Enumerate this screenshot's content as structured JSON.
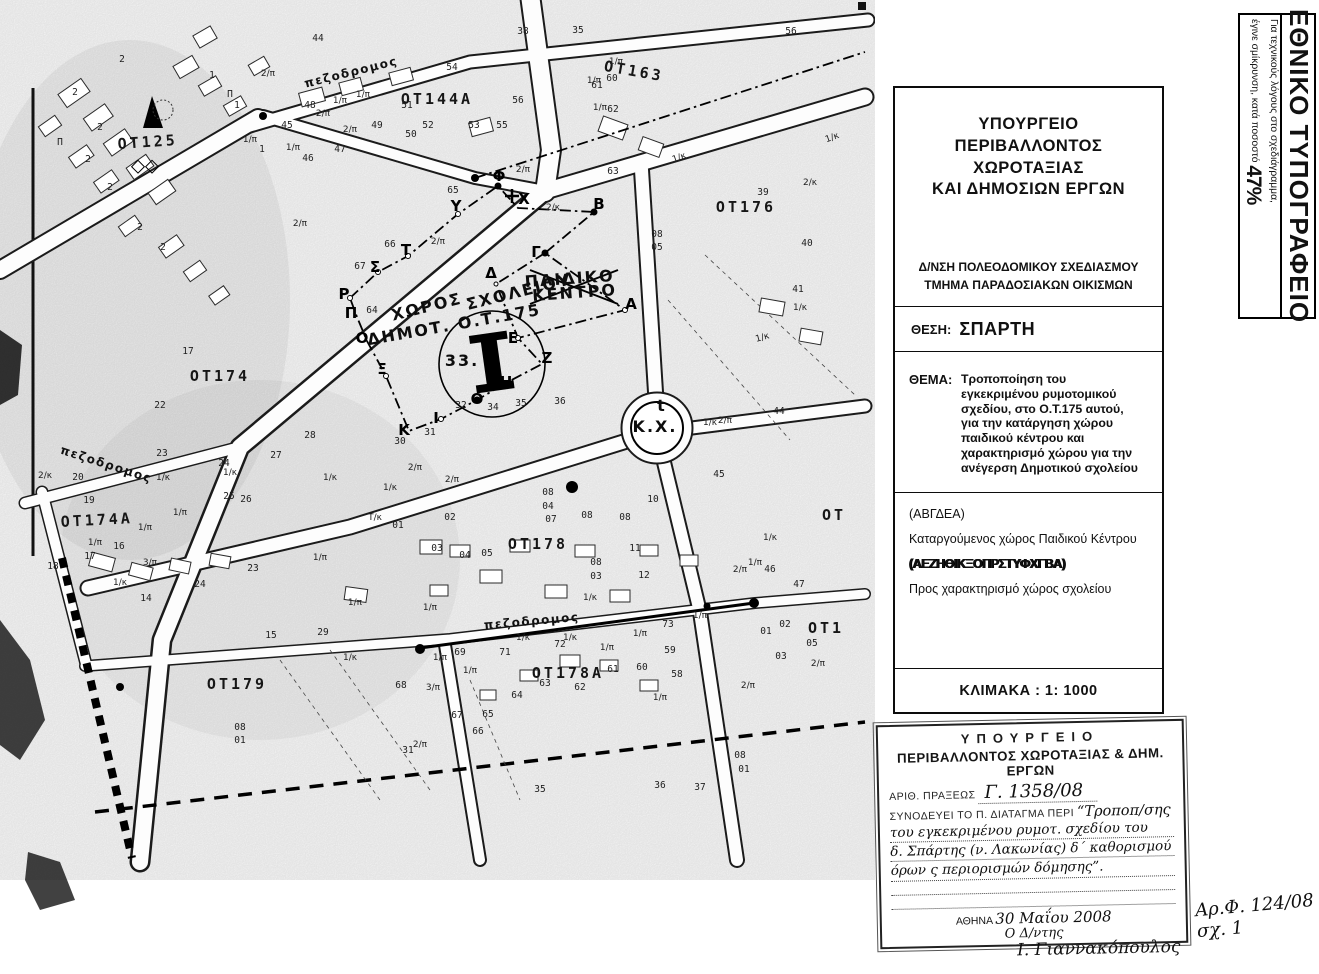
{
  "banner": {
    "title": "ΕΘΝΙΚΟ ΤΥΠΟΓΡΑΦΕΙΟ",
    "note1": "Για τεχνικούς λόγους στο σχεδιάγραμμα,",
    "note2": "έγινε σμίκρυνση, κατά ποσοστό",
    "percent": "47%"
  },
  "title_block": {
    "ministry": [
      "ΥΠΟΥΡΓΕΙΟ",
      "ΠΕΡΙΒΑΛΛΟΝΤΟΣ",
      "ΧΩΡΟΤΑΞΙΑΣ",
      "ΚΑΙ ΔΗΜΟΣΙΩΝ ΕΡΓΩΝ"
    ],
    "directorate": "Δ/ΝΣΗ ΠΟΛΕΟΔΟΜΙΚΟΥ ΣΧΕΔΙΑΣΜΟΥ",
    "department": "ΤΜΗΜΑ ΠΑΡΑΔΟΣΙΑΚΩΝ ΟΙΚΙΣΜΩΝ",
    "location_label": "ΘΕΣΗ:",
    "location": "ΣΠΑΡΤΗ",
    "subject_label": "ΘΕΜΑ:",
    "subject_lines": [
      "Τροποποίηση του",
      "εγκεκριμένου ρυμοτομικού",
      "σχεδίου, στο Ο.Τ.175 αυτού,",
      "για την κατάργηση χώρου",
      "παιδικού κέντρου και",
      "χαρακτηρισμό χώρου για την",
      "ανέγερση Δημοτικού σχολείου"
    ],
    "legend": {
      "code1": "(ΑΒΓΔΕΑ)",
      "desc1": "Καταργούμενος χώρος Παιδικού Κέντρου",
      "code2": "(ΑΕΖΗΘΙΚΞΟΠΡΣΤΥΦΧΓΒΑ)",
      "desc2": "Προς χαρακτηρισμό χώρος σχολείου"
    },
    "scale": "ΚΛΙΜΑΚΑ : 1: 1000"
  },
  "stamp": {
    "header1": "ΥΠΟΥΡΓΕΙΟ",
    "header2": "ΠΕΡΙΒΑΛΛΟΝΤΟΣ ΧΩΡΟΤΑΞΙΑΣ & ΔΗΜ. ΕΡΓΩΝ",
    "row1_label": "ΑΡΙΘ. ΠΡΑΞΕΩΣ",
    "row1_value": "Γ. 1358/08",
    "row2_label": "ΣΥΝΟΔΕΥΕΙ ΤΟ Π. ΔΙΑΤΑΓΜΑ ΠΕΡΙ",
    "row2_value": "“Τροποπ/σης",
    "hw_line1": "του εγκεκριμένου ρυμοτ. σχεδίου του",
    "hw_line2": "δ. Σπάρτης (ν. Λακωνίας) δ΄ καθορισμού",
    "hw_line3": "όρων ς περιορισμών δόμησης”.",
    "city_label": "ΑΘΗΝΑ",
    "date": "30 Μαΐου 2008",
    "signer_title": "Ο Δ/ντης",
    "signature": "Ι. Γιαννακόπουλος"
  },
  "file_note": {
    "line1": "Αρ.Φ. 124/08",
    "line2": "σχ. 1"
  },
  "map": {
    "blocks": [
      {
        "t": "ΟΤ125",
        "x": 148,
        "y": 147,
        "r": -4
      },
      {
        "t": "ΟΤ144Α",
        "x": 437,
        "y": 104,
        "r": 0
      },
      {
        "t": "ΟΤ163",
        "x": 633,
        "y": 76,
        "r": 10
      },
      {
        "t": "ΟΤ176",
        "x": 746,
        "y": 212,
        "r": 0
      },
      {
        "t": "ΟΤ174",
        "x": 220,
        "y": 381,
        "r": 0
      },
      {
        "t": "ΟΤ174Α",
        "x": 97,
        "y": 525,
        "r": -3
      },
      {
        "t": "ΟΤ178",
        "x": 538,
        "y": 549,
        "r": 0
      },
      {
        "t": "ΟΤ178Α",
        "x": 568,
        "y": 678,
        "r": 0
      },
      {
        "t": "ΟΤ179",
        "x": 237,
        "y": 689,
        "r": 0
      },
      {
        "t": "ΟΤ",
        "x": 834,
        "y": 520,
        "r": 0
      },
      {
        "t": "ΟΤ1",
        "x": 826,
        "y": 633,
        "r": 0
      }
    ],
    "street_labels": [
      {
        "t": "πεζοδρομος",
        "x": 352,
        "y": 76,
        "r": -14
      },
      {
        "t": "πεζοδρομος",
        "x": 105,
        "y": 468,
        "r": 18
      },
      {
        "t": "πεζοδρομος",
        "x": 532,
        "y": 625,
        "r": -5
      }
    ],
    "site_labels": [
      {
        "t": "ΧΩΡΟΣ",
        "x": 428,
        "y": 312,
        "r": -14
      },
      {
        "t": "ΣΧΟΛΕΙΟΥ",
        "x": 520,
        "y": 297,
        "r": -14
      },
      {
        "t": "ΔΗΜΟΤ. Ο.Τ.175",
        "x": 455,
        "y": 330,
        "r": -10
      },
      {
        "t": "ΠΑΙΔΙΚΟ",
        "x": 570,
        "y": 284,
        "r": -4,
        "small": true
      },
      {
        "t": "ΚΕΝΤΡΟ",
        "x": 575,
        "y": 298,
        "r": -4,
        "small": true
      },
      {
        "t": "Κ.Χ.",
        "x": 655,
        "y": 432,
        "r": 0,
        "small": true
      },
      {
        "t": "t",
        "x": 662,
        "y": 411,
        "r": 0,
        "small": true
      },
      {
        "t": "33.",
        "x": 462,
        "y": 366,
        "r": 0,
        "small": true
      }
    ],
    "vertex_letters": [
      {
        "t": "Ρ",
        "x": 344,
        "y": 299
      },
      {
        "t": "Σ",
        "x": 375,
        "y": 272
      },
      {
        "t": "Τ",
        "x": 406,
        "y": 255
      },
      {
        "t": "Υ",
        "x": 456,
        "y": 211
      },
      {
        "t": "Φ",
        "x": 499,
        "y": 181
      },
      {
        "t": "Χ",
        "x": 524,
        "y": 204
      },
      {
        "t": "Β",
        "x": 599,
        "y": 209
      },
      {
        "t": "Γ",
        "x": 536,
        "y": 257
      },
      {
        "t": "Α",
        "x": 631,
        "y": 309
      },
      {
        "t": "Δ",
        "x": 491,
        "y": 278
      },
      {
        "t": "Ε",
        "x": 513,
        "y": 343
      },
      {
        "t": "Ζ",
        "x": 547,
        "y": 363
      },
      {
        "t": "Η",
        "x": 506,
        "y": 387
      },
      {
        "t": "Θ",
        "x": 477,
        "y": 404
      },
      {
        "t": "Ι",
        "x": 436,
        "y": 423
      },
      {
        "t": "Κ",
        "x": 404,
        "y": 435
      },
      {
        "t": "Ξ",
        "x": 382,
        "y": 374
      },
      {
        "t": "Ο",
        "x": 362,
        "y": 343
      },
      {
        "t": "Π",
        "x": 351,
        "y": 318
      }
    ],
    "numbers": [
      {
        "t": "44",
        "x": 318,
        "y": 41
      },
      {
        "t": "54",
        "x": 452,
        "y": 70
      },
      {
        "t": "38",
        "x": 523,
        "y": 34
      },
      {
        "t": "35",
        "x": 578,
        "y": 33
      },
      {
        "t": "56",
        "x": 791,
        "y": 34
      },
      {
        "t": "45",
        "x": 287,
        "y": 128
      },
      {
        "t": "46",
        "x": 308,
        "y": 161
      },
      {
        "t": "47",
        "x": 340,
        "y": 152
      },
      {
        "t": "48",
        "x": 310,
        "y": 108
      },
      {
        "t": "49",
        "x": 377,
        "y": 128
      },
      {
        "t": "50",
        "x": 411,
        "y": 137
      },
      {
        "t": "51",
        "x": 407,
        "y": 108
      },
      {
        "t": "52",
        "x": 428,
        "y": 128
      },
      {
        "t": "53",
        "x": 474,
        "y": 128
      },
      {
        "t": "55",
        "x": 502,
        "y": 128
      },
      {
        "t": "56",
        "x": 518,
        "y": 103
      },
      {
        "t": "60",
        "x": 612,
        "y": 81
      },
      {
        "t": "61",
        "x": 597,
        "y": 88
      },
      {
        "t": "62",
        "x": 613,
        "y": 112
      },
      {
        "t": "63",
        "x": 613,
        "y": 174
      },
      {
        "t": "39",
        "x": 763,
        "y": 195
      },
      {
        "t": "40",
        "x": 807,
        "y": 246
      },
      {
        "t": "41",
        "x": 798,
        "y": 292
      },
      {
        "t": "65",
        "x": 453,
        "y": 193
      },
      {
        "t": "66",
        "x": 390,
        "y": 247
      },
      {
        "t": "67",
        "x": 360,
        "y": 269
      },
      {
        "t": "64",
        "x": 372,
        "y": 313
      },
      {
        "t": "08",
        "x": 657,
        "y": 237
      },
      {
        "t": "05",
        "x": 657,
        "y": 250
      },
      {
        "t": "17",
        "x": 188,
        "y": 354
      },
      {
        "t": "22",
        "x": 160,
        "y": 408
      },
      {
        "t": "23",
        "x": 162,
        "y": 456
      },
      {
        "t": "24",
        "x": 224,
        "y": 466
      },
      {
        "t": "25",
        "x": 229,
        "y": 499
      },
      {
        "t": "26",
        "x": 246,
        "y": 502
      },
      {
        "t": "27",
        "x": 276,
        "y": 458
      },
      {
        "t": "28",
        "x": 310,
        "y": 438
      },
      {
        "t": "30",
        "x": 400,
        "y": 444
      },
      {
        "t": "31",
        "x": 430,
        "y": 435
      },
      {
        "t": "32",
        "x": 461,
        "y": 408
      },
      {
        "t": "34",
        "x": 493,
        "y": 410
      },
      {
        "t": "35",
        "x": 521,
        "y": 406
      },
      {
        "t": "36",
        "x": 560,
        "y": 404
      },
      {
        "t": "44",
        "x": 779,
        "y": 414
      },
      {
        "t": "45",
        "x": 719,
        "y": 477
      },
      {
        "t": "10",
        "x": 653,
        "y": 502
      },
      {
        "t": "11",
        "x": 635,
        "y": 551
      },
      {
        "t": "12",
        "x": 644,
        "y": 578
      },
      {
        "t": "46",
        "x": 770,
        "y": 572
      },
      {
        "t": "47",
        "x": 799,
        "y": 587
      },
      {
        "t": "20",
        "x": 78,
        "y": 480
      },
      {
        "t": "19",
        "x": 89,
        "y": 503
      },
      {
        "t": "18",
        "x": 53,
        "y": 569
      },
      {
        "t": "17",
        "x": 90,
        "y": 559
      },
      {
        "t": "16",
        "x": 119,
        "y": 549
      },
      {
        "t": "14",
        "x": 146,
        "y": 601
      },
      {
        "t": "23",
        "x": 253,
        "y": 571
      },
      {
        "t": "24",
        "x": 200,
        "y": 587
      },
      {
        "t": "15",
        "x": 271,
        "y": 638
      },
      {
        "t": "29",
        "x": 323,
        "y": 635
      },
      {
        "t": "01",
        "x": 398,
        "y": 528
      },
      {
        "t": "02",
        "x": 450,
        "y": 520
      },
      {
        "t": "03",
        "x": 437,
        "y": 551
      },
      {
        "t": "04",
        "x": 465,
        "y": 558
      },
      {
        "t": "05",
        "x": 487,
        "y": 556
      },
      {
        "t": "07",
        "x": 551,
        "y": 522
      },
      {
        "t": "08",
        "x": 587,
        "y": 518
      },
      {
        "t": "08",
        "x": 625,
        "y": 520
      },
      {
        "t": "08",
        "x": 548,
        "y": 495
      },
      {
        "t": "04",
        "x": 548,
        "y": 509
      },
      {
        "t": "08",
        "x": 596,
        "y": 565
      },
      {
        "t": "03",
        "x": 596,
        "y": 579
      },
      {
        "t": "69",
        "x": 460,
        "y": 655
      },
      {
        "t": "71",
        "x": 505,
        "y": 655
      },
      {
        "t": "72",
        "x": 560,
        "y": 647
      },
      {
        "t": "73",
        "x": 668,
        "y": 627
      },
      {
        "t": "59",
        "x": 670,
        "y": 653
      },
      {
        "t": "60",
        "x": 642,
        "y": 670
      },
      {
        "t": "58",
        "x": 677,
        "y": 677
      },
      {
        "t": "61",
        "x": 613,
        "y": 672
      },
      {
        "t": "62",
        "x": 580,
        "y": 690
      },
      {
        "t": "63",
        "x": 545,
        "y": 686
      },
      {
        "t": "64",
        "x": 517,
        "y": 698
      },
      {
        "t": "65",
        "x": 488,
        "y": 717
      },
      {
        "t": "66",
        "x": 478,
        "y": 734
      },
      {
        "t": "67",
        "x": 457,
        "y": 718
      },
      {
        "t": "68",
        "x": 401,
        "y": 688
      },
      {
        "t": "08",
        "x": 240,
        "y": 730
      },
      {
        "t": "01",
        "x": 240,
        "y": 743
      },
      {
        "t": "08",
        "x": 740,
        "y": 758
      },
      {
        "t": "01",
        "x": 744,
        "y": 772
      },
      {
        "t": "35",
        "x": 540,
        "y": 792
      },
      {
        "t": "36",
        "x": 660,
        "y": 788
      },
      {
        "t": "37",
        "x": 700,
        "y": 790
      },
      {
        "t": "31",
        "x": 408,
        "y": 753
      },
      {
        "t": "02",
        "x": 785,
        "y": 627
      },
      {
        "t": "01",
        "x": 766,
        "y": 634
      },
      {
        "t": "05",
        "x": 812,
        "y": 646
      },
      {
        "t": "03",
        "x": 781,
        "y": 659
      },
      {
        "t": "2",
        "x": 75,
        "y": 95
      },
      {
        "t": "2",
        "x": 100,
        "y": 130
      },
      {
        "t": "2",
        "x": 88,
        "y": 162
      },
      {
        "t": "2",
        "x": 110,
        "y": 190
      },
      {
        "t": "2",
        "x": 140,
        "y": 230
      },
      {
        "t": "1",
        "x": 212,
        "y": 78
      },
      {
        "t": "1",
        "x": 237,
        "y": 108
      },
      {
        "t": "2",
        "x": 122,
        "y": 62
      },
      {
        "t": "1",
        "x": 262,
        "y": 152
      },
      {
        "t": "2",
        "x": 163,
        "y": 250
      },
      {
        "t": "Π",
        "x": 230,
        "y": 97
      },
      {
        "t": "Π",
        "x": 60,
        "y": 145
      }
    ],
    "parcel_marks": [
      {
        "t": "2/π",
        "x": 268,
        "y": 76
      },
      {
        "t": "2/π",
        "x": 323,
        "y": 116
      },
      {
        "t": "1/π",
        "x": 340,
        "y": 103
      },
      {
        "t": "1/π",
        "x": 363,
        "y": 97
      },
      {
        "t": "2/π",
        "x": 350,
        "y": 132
      },
      {
        "t": "1/π",
        "x": 293,
        "y": 150
      },
      {
        "t": "1/π",
        "x": 250,
        "y": 142
      },
      {
        "t": "2/π",
        "x": 300,
        "y": 226
      },
      {
        "t": "2/π",
        "x": 438,
        "y": 244
      },
      {
        "t": "2/π",
        "x": 523,
        "y": 172
      },
      {
        "t": "1/π",
        "x": 616,
        "y": 64
      },
      {
        "t": "1/π",
        "x": 594,
        "y": 83
      },
      {
        "t": "1/π",
        "x": 600,
        "y": 110
      },
      {
        "t": "1/κ",
        "x": 680,
        "y": 160,
        "r": -20
      },
      {
        "t": "2/κ",
        "x": 553,
        "y": 210
      },
      {
        "t": "1/κ",
        "x": 833,
        "y": 140,
        "r": -20
      },
      {
        "t": "2/κ",
        "x": 810,
        "y": 185
      },
      {
        "t": "1/κ",
        "x": 800,
        "y": 310
      },
      {
        "t": "1/κ",
        "x": 763,
        "y": 340,
        "r": -15
      },
      {
        "t": "1/κ",
        "x": 710,
        "y": 425
      },
      {
        "t": "2/π",
        "x": 725,
        "y": 423
      },
      {
        "t": "1/π",
        "x": 755,
        "y": 565
      },
      {
        "t": "1/κ",
        "x": 770,
        "y": 540
      },
      {
        "t": "1/π",
        "x": 700,
        "y": 618
      },
      {
        "t": "1/π",
        "x": 640,
        "y": 636
      },
      {
        "t": "1/κ",
        "x": 590,
        "y": 600
      },
      {
        "t": "1/κ",
        "x": 570,
        "y": 640
      },
      {
        "t": "1/π",
        "x": 607,
        "y": 650
      },
      {
        "t": "1/π",
        "x": 470,
        "y": 673
      },
      {
        "t": "1/π",
        "x": 440,
        "y": 660
      },
      {
        "t": "1/π",
        "x": 430,
        "y": 610
      },
      {
        "t": "1/π",
        "x": 355,
        "y": 605
      },
      {
        "t": "1/κ",
        "x": 330,
        "y": 480
      },
      {
        "t": "1/κ",
        "x": 390,
        "y": 490
      },
      {
        "t": "2/π",
        "x": 415,
        "y": 470
      },
      {
        "t": "2/π",
        "x": 452,
        "y": 482
      },
      {
        "t": "1/π",
        "x": 320,
        "y": 560
      },
      {
        "t": "3/π",
        "x": 150,
        "y": 565
      },
      {
        "t": "1/κ",
        "x": 163,
        "y": 480
      },
      {
        "t": "1/κ",
        "x": 230,
        "y": 475
      },
      {
        "t": "2/κ",
        "x": 45,
        "y": 478
      },
      {
        "t": "1/π",
        "x": 180,
        "y": 515
      },
      {
        "t": "1/π",
        "x": 145,
        "y": 530
      },
      {
        "t": "1/π",
        "x": 95,
        "y": 545
      },
      {
        "t": "1/κ",
        "x": 120,
        "y": 585
      },
      {
        "t": "2/π",
        "x": 740,
        "y": 572
      },
      {
        "t": "2/π",
        "x": 818,
        "y": 666
      },
      {
        "t": "1/π",
        "x": 660,
        "y": 700
      },
      {
        "t": "3/π",
        "x": 433,
        "y": 690
      },
      {
        "t": "2/π",
        "x": 420,
        "y": 747
      },
      {
        "t": "1/κ",
        "x": 523,
        "y": 640
      },
      {
        "t": "Τ/κ",
        "x": 375,
        "y": 520
      },
      {
        "t": "1/κ",
        "x": 350,
        "y": 660
      },
      {
        "t": "2/π",
        "x": 748,
        "y": 688
      }
    ]
  }
}
